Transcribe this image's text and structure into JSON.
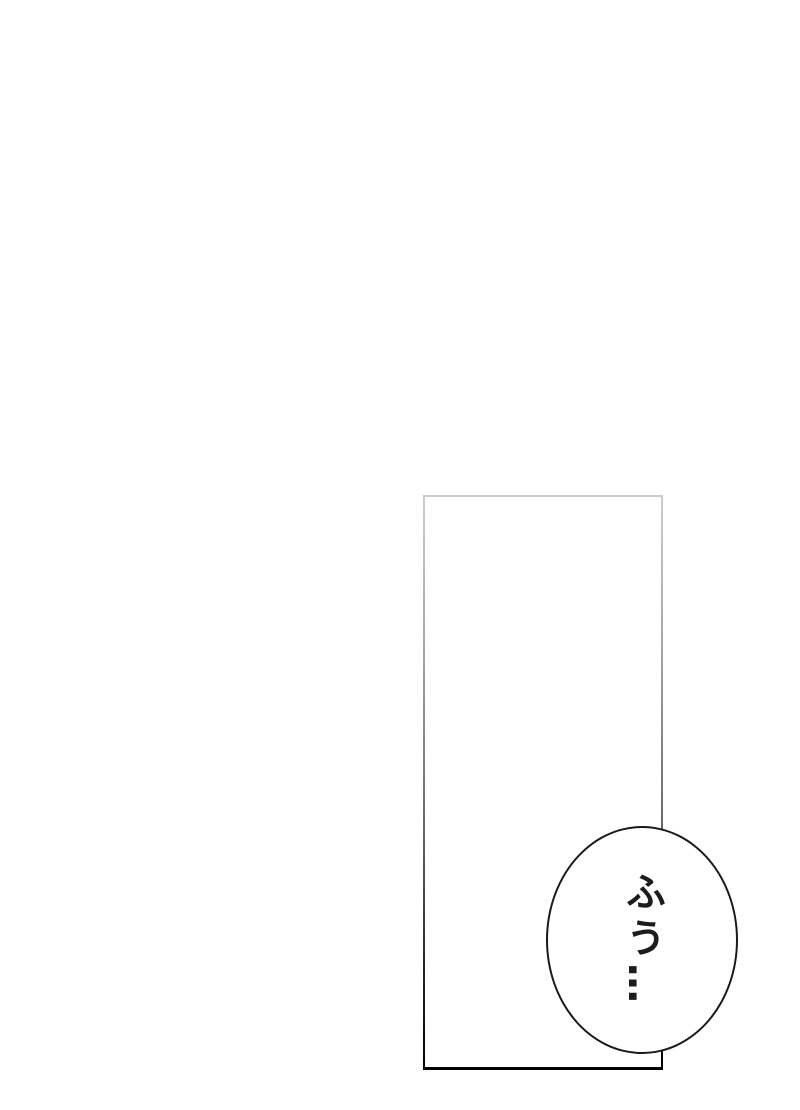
{
  "page": {
    "background_color": "#ffffff"
  },
  "panel": {
    "border_top_color": "#cdcdcd",
    "border_bottom_color": "#000000"
  },
  "speech_bubble": {
    "text": "ふう…",
    "fill_color": "#ffffff",
    "border_color": "#1a1a1a",
    "text_color": "#1c1c1c"
  }
}
